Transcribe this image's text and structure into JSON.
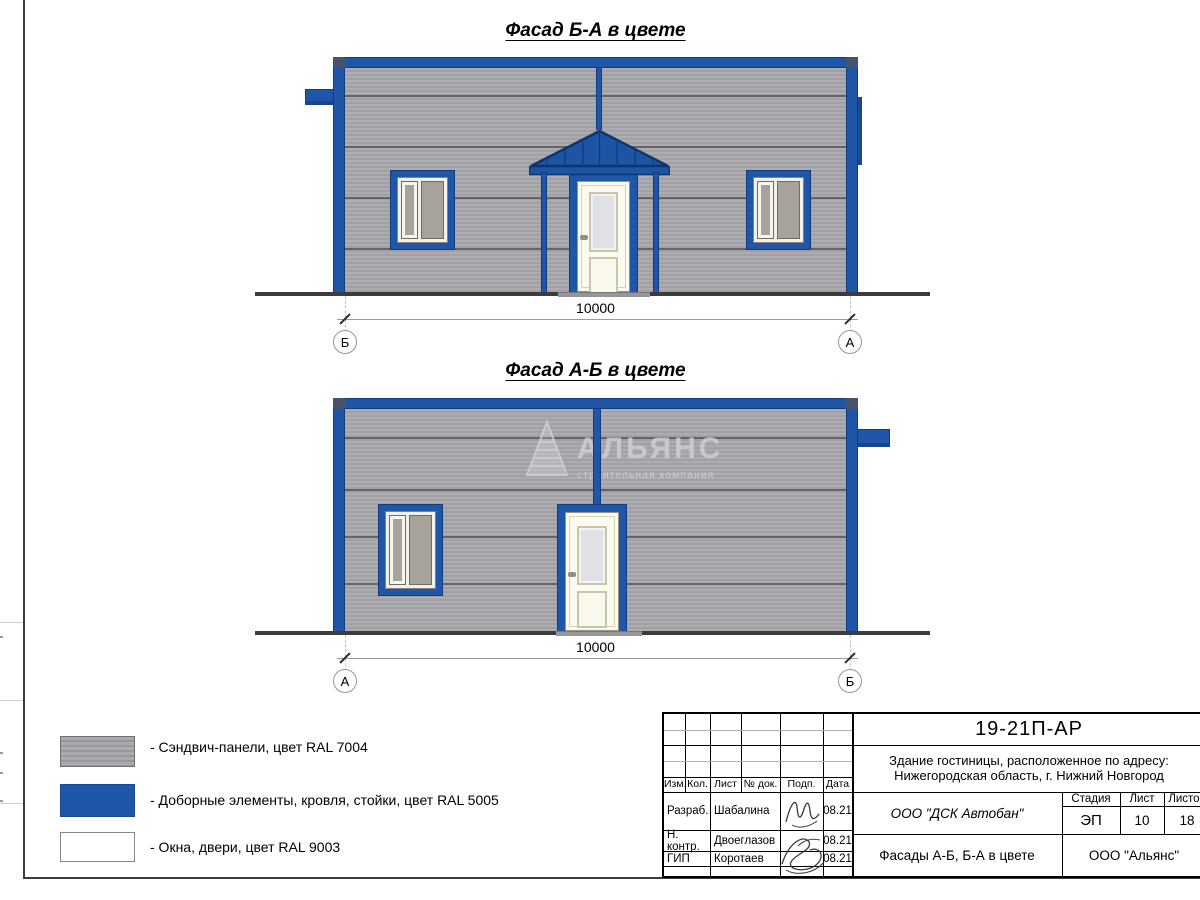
{
  "facades": {
    "f1": {
      "title": "Фасад Б-А в цвете",
      "dimension": "10000",
      "axis_left": "Б",
      "axis_right": "А"
    },
    "f2": {
      "title": "Фасад А-Б в цвете",
      "dimension": "10000",
      "axis_left": "А",
      "axis_right": "Б"
    }
  },
  "watermark": {
    "name": "АЛЬЯНС",
    "subtitle": "строительная компания"
  },
  "legend": {
    "items": [
      {
        "label": "- Сэндвич-панели, цвет RAL 7004",
        "color": "#a2a2a6"
      },
      {
        "label": "- Доборные элементы, кровля, стойки, цвет RAL 5005",
        "color": "#2056a8"
      },
      {
        "label": "- Окна, двери, цвет RAL 9003",
        "color": "#ffffff"
      }
    ]
  },
  "title_block": {
    "doc_number": "19-21П-АР",
    "project_address_line1": "Здание гостиницы, расположенное по адресу:",
    "project_address_line2": "Нижегородская область, г. Нижний Новгород",
    "columns": [
      "Изм.",
      "Кол.",
      "Лист",
      "№ док.",
      "Подп.",
      "Дата"
    ],
    "signers": [
      {
        "role": "Разраб.",
        "name": "Шабалина",
        "date": "08.21"
      },
      {
        "role": "Н. контр.",
        "name": "Двоеглазов",
        "date": "08.21"
      },
      {
        "role": "ГИП",
        "name": "Коротаев",
        "date": "08.21"
      }
    ],
    "contractor": "ООО \"ДСК Автобан\"",
    "stage_label": "Стадия",
    "stage_value": "ЭП",
    "sheet_label": "Лист",
    "sheet_value": "10",
    "sheets_label": "Листов",
    "sheets_value": "18",
    "drawing_title": "Фасады А-Б, Б-А в цвете",
    "organization": "ООО \"Альянс\""
  },
  "colors": {
    "panel_ral7004": "#a2a2a6",
    "blue_ral5005": "#2056a8",
    "white_ral9003": "#ffffff"
  }
}
